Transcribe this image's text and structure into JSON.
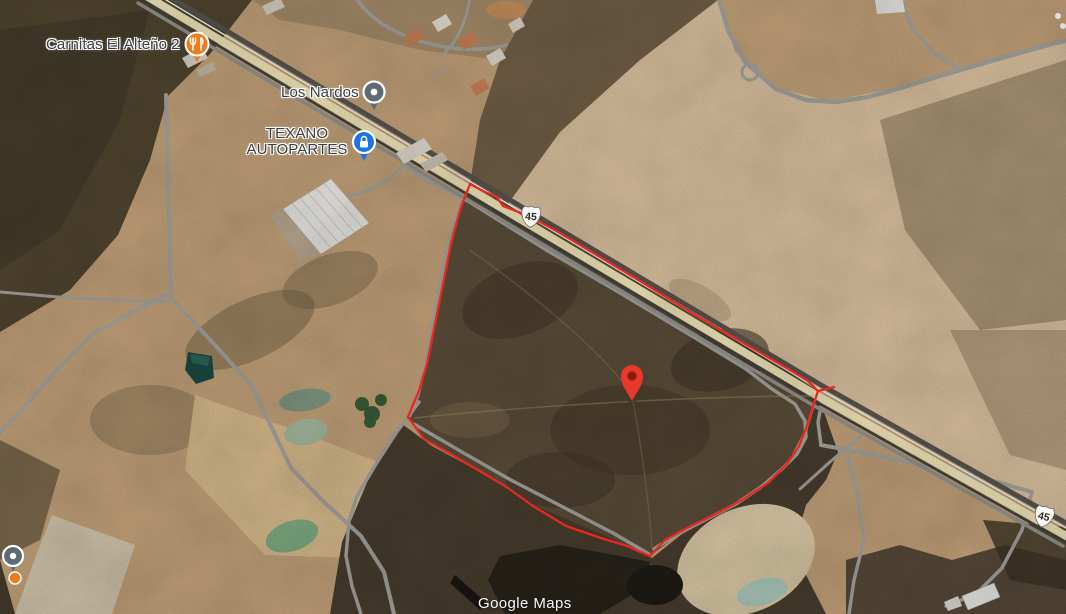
{
  "map": {
    "watermark": "Google Maps",
    "pois": [
      {
        "label": "Carnitas El Alteño 2",
        "category": "restaurant",
        "icon": "restaurant-icon",
        "pin_color": "#ee7c1b"
      },
      {
        "label": "Los Nardos",
        "category": "place",
        "icon": "dot-icon",
        "pin_color": "#5d6b74"
      },
      {
        "label_line1": "TEXANO",
        "label_line2": "AUTOPARTES",
        "category": "auto-parts-store",
        "icon": "lock-icon",
        "pin_color": "#1a73e8"
      }
    ],
    "route_shields": [
      {
        "number": "45"
      },
      {
        "number": "45"
      }
    ],
    "marker": {
      "type": "dropped-pin",
      "color": "#e8382b"
    },
    "parcel": {
      "outline_color": "#e8281e"
    },
    "colors": {
      "highway_surface": "#efe4b8",
      "terrain_base": "#c1a078"
    }
  }
}
